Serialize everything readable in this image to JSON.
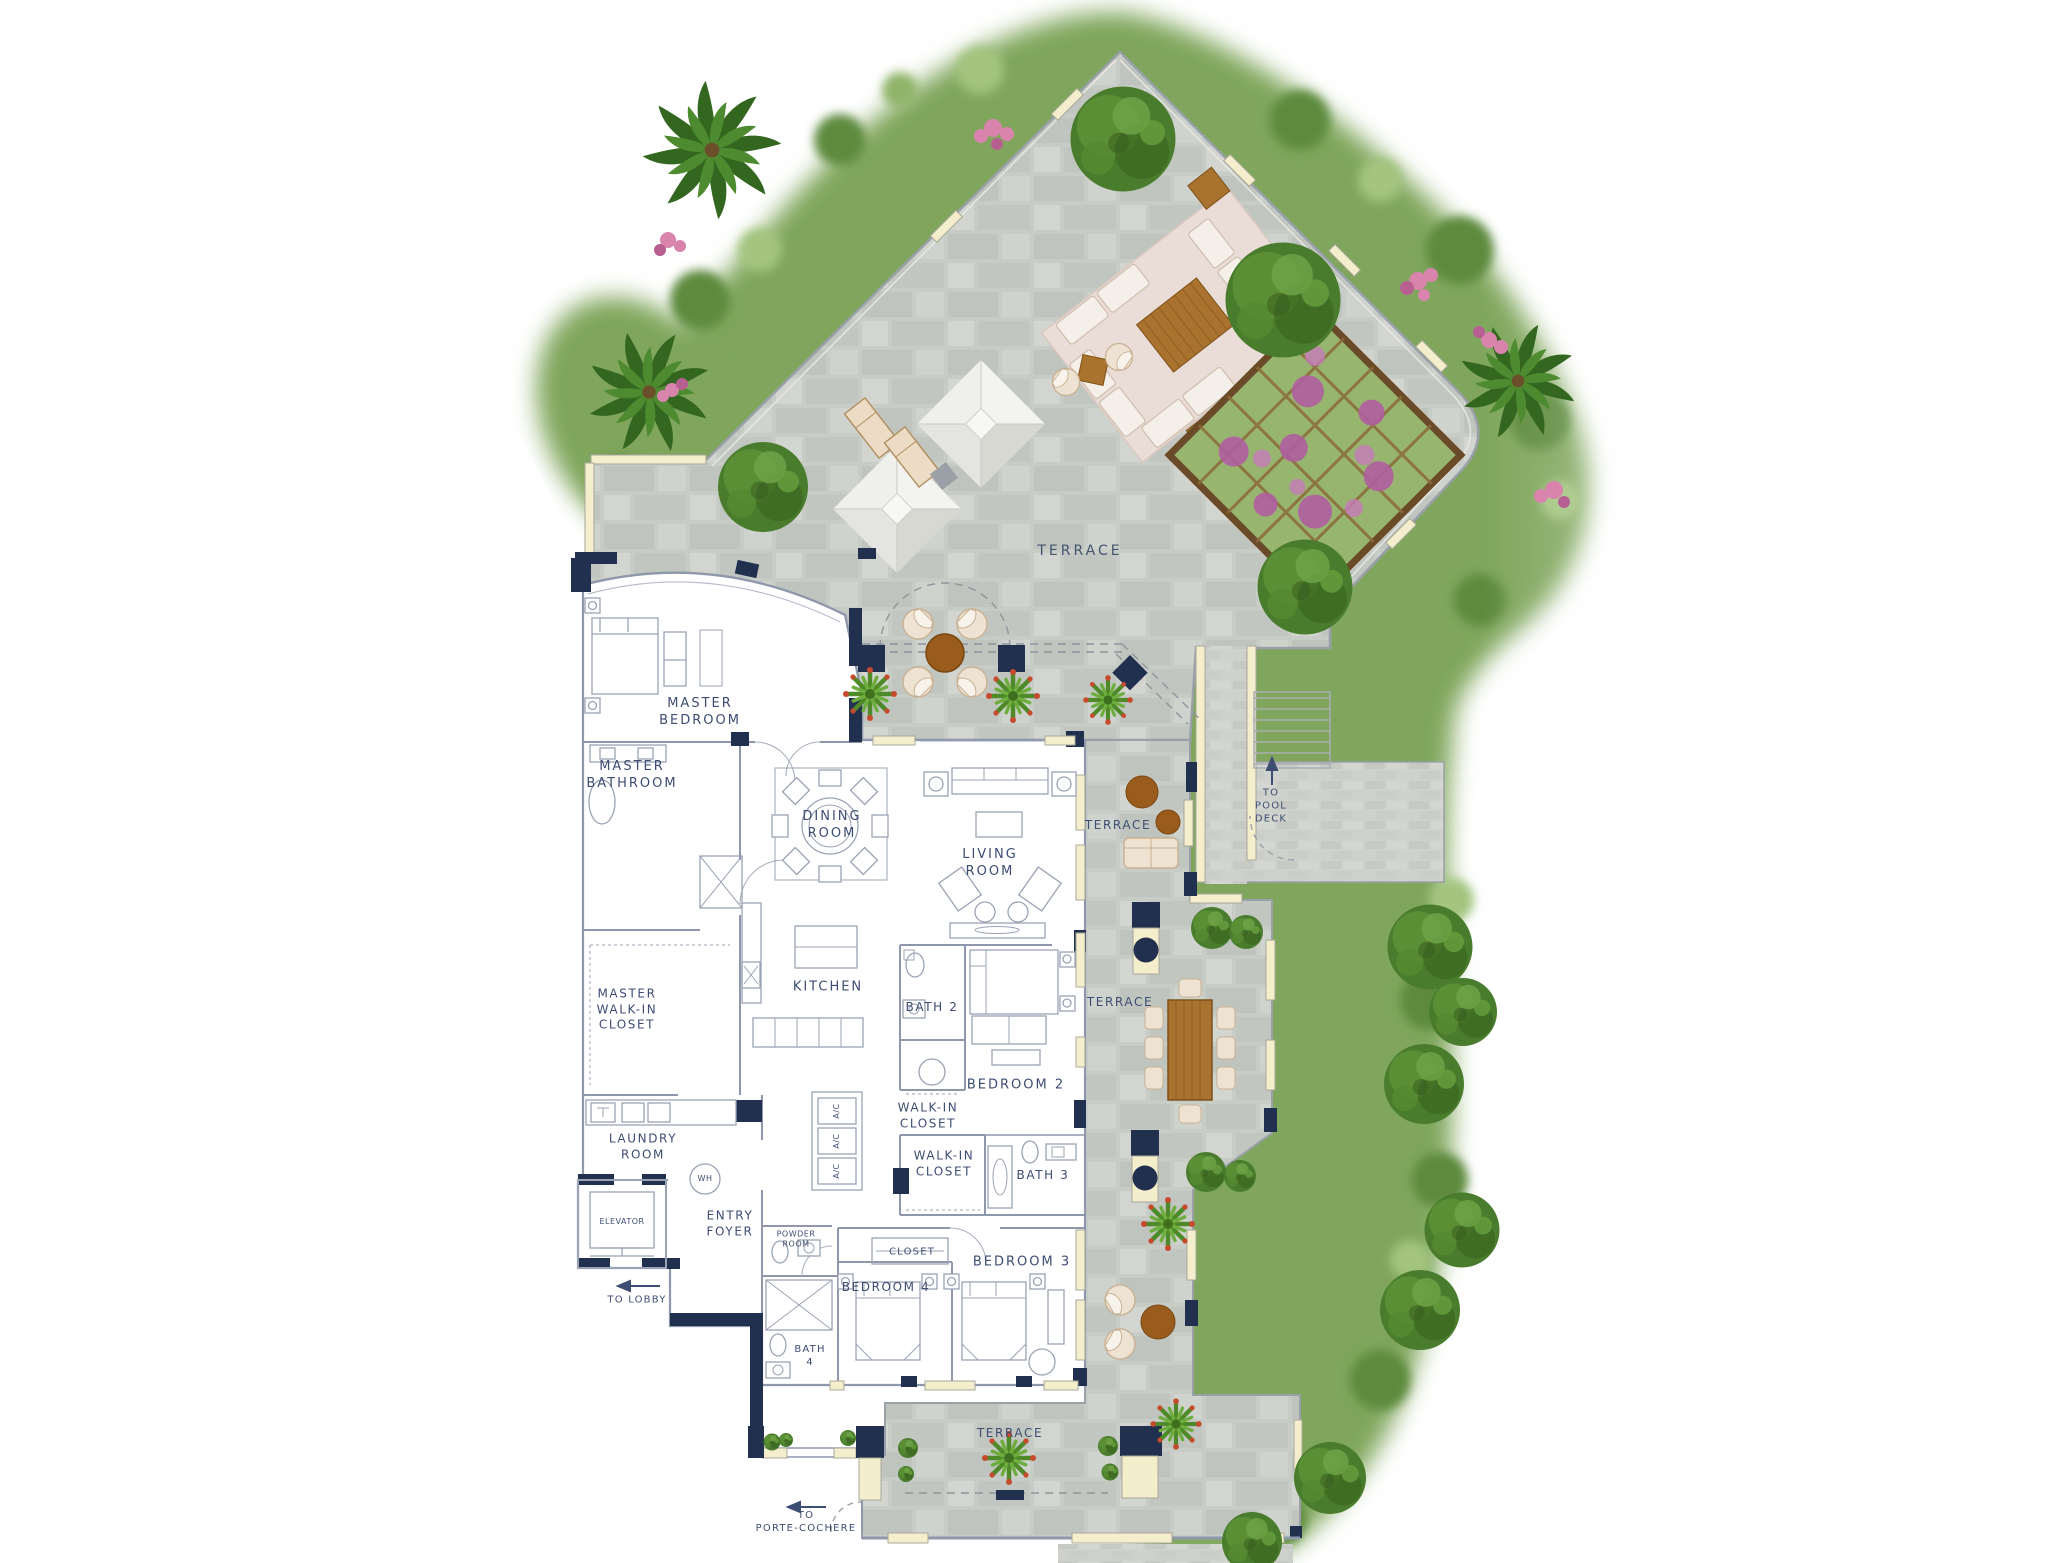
{
  "plan_type": "residence floor plan with terraces",
  "palette": {
    "navy": "#22304f",
    "label_text": "#3d4d73",
    "paver_gray": "#c8ccc7",
    "walkway_gray": "#cfd1cc",
    "cream_window": "#f4eecd",
    "hedge_green": "#7fa65c",
    "tree_green": "#497c2c",
    "wood_brown": "#a9732f",
    "cushion_beige": "#ecdcc6",
    "wall_line": "#8e97ab"
  },
  "rooms": [
    {
      "id": "master-bedroom",
      "lines": [
        "MASTER",
        "BEDROOM"
      ]
    },
    {
      "id": "master-bathroom",
      "lines": [
        "MASTER",
        "BATHROOM"
      ]
    },
    {
      "id": "master-walk-in-closet",
      "lines": [
        "MASTER",
        "WALK-IN",
        "CLOSET"
      ]
    },
    {
      "id": "dining-room",
      "lines": [
        "DINING",
        "ROOM"
      ]
    },
    {
      "id": "living-room",
      "lines": [
        "LIVING",
        "ROOM"
      ]
    },
    {
      "id": "kitchen",
      "lines": [
        "KITCHEN"
      ]
    },
    {
      "id": "bath-2",
      "lines": [
        "BATH 2"
      ]
    },
    {
      "id": "bedroom-2",
      "lines": [
        "BEDROOM 2"
      ]
    },
    {
      "id": "walk-in-closet-2",
      "lines": [
        "WALK-IN",
        "CLOSET"
      ]
    },
    {
      "id": "walk-in-closet-3",
      "lines": [
        "WALK-IN",
        "CLOSET"
      ]
    },
    {
      "id": "bath-3",
      "lines": [
        "BATH 3"
      ]
    },
    {
      "id": "laundry-room",
      "lines": [
        "LAUNDRY",
        "ROOM"
      ]
    },
    {
      "id": "entry-foyer",
      "lines": [
        "ENTRY",
        "FOYER"
      ]
    },
    {
      "id": "powder-room",
      "lines": [
        "POWDER",
        "ROOM"
      ]
    },
    {
      "id": "elevator",
      "lines": [
        "ELEVATOR"
      ]
    },
    {
      "id": "closet",
      "lines": [
        "CLOSET"
      ]
    },
    {
      "id": "bedroom-4",
      "lines": [
        "BEDROOM 4"
      ]
    },
    {
      "id": "bedroom-3",
      "lines": [
        "BEDROOM 3"
      ]
    },
    {
      "id": "bath-4",
      "lines": [
        "BATH",
        "4"
      ]
    }
  ],
  "terraces": [
    {
      "id": "terrace-main",
      "label": "TERRACE"
    },
    {
      "id": "terrace-mid",
      "label": "TERRACE"
    },
    {
      "id": "terrace-east",
      "label": "TERRACE"
    },
    {
      "id": "terrace-south",
      "label": "TERRACE"
    }
  ],
  "utilities": {
    "water_heater": "WH",
    "ac": "A/C"
  },
  "wayfinding": [
    {
      "id": "to-pool-deck",
      "lines": [
        "TO",
        "POOL",
        "DECK"
      ],
      "direction": "up"
    },
    {
      "id": "to-lobby",
      "lines": [
        "TO LOBBY"
      ],
      "direction": "left"
    },
    {
      "id": "to-porte-cochere",
      "lines": [
        "TO",
        "PORTE-COCHERE"
      ],
      "direction": "left"
    }
  ],
  "icons": {
    "up_arrow": "↑",
    "left_arrow": "⟵"
  }
}
